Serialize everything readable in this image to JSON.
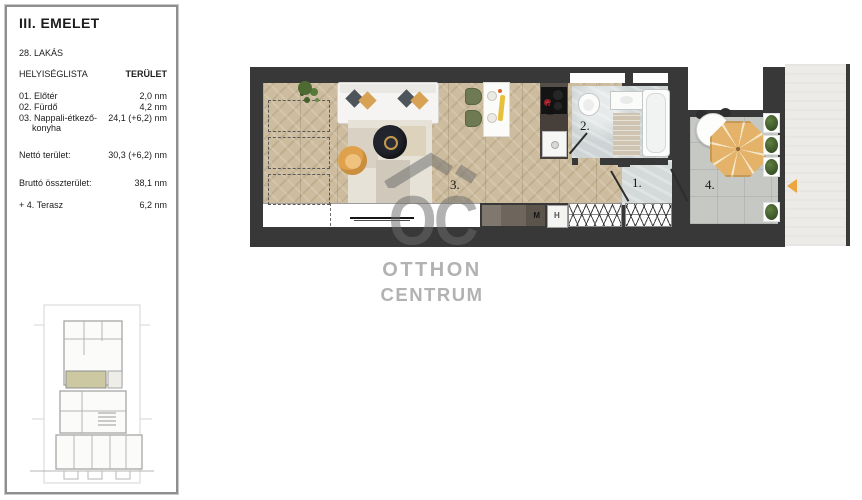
{
  "sidebar": {
    "floor_title": "III. EMELET",
    "apartment_label": "28. LAKÁS",
    "columns": {
      "rooms": "HELYISÉGLISTA",
      "area": "TERÜLET"
    },
    "rooms": [
      {
        "label": "01. Előtér",
        "area": "2,0 nm"
      },
      {
        "label": "02. Fürdő",
        "area": "4,2 nm"
      },
      {
        "label": "03. Nappali-étkező-",
        "label_line2": "konyha",
        "area": "24,1 (+6,2) nm"
      }
    ],
    "totals": [
      {
        "label": "Nettó terület:",
        "value": "30,3 (+6,2) nm"
      },
      {
        "label": "Bruttó összterület:",
        "value": "38,1 nm"
      },
      {
        "label": "+ 4. Terasz",
        "value": "6,2 nm"
      }
    ]
  },
  "plan": {
    "room_numbers": {
      "entry": "1.",
      "bathroom": "2.",
      "living": "3.",
      "terrace": "4."
    },
    "appliances": {
      "dishwasher": "MG",
      "washer": "M",
      "fridge": "H"
    },
    "colors": {
      "wall": "#383838",
      "wood_floor": "#cdbc9d",
      "bath_floor": "#ced4d5",
      "terrace_floor": "#c6c8c4",
      "corridor": "#ecebe8",
      "parasol": "#e4b269",
      "entrance_arrow": "#eca63f",
      "unit_highlight": "#ccc8a2"
    }
  },
  "watermark": {
    "monogram": "OC",
    "line1": "OTTHON",
    "line2": "CENTRUM"
  }
}
